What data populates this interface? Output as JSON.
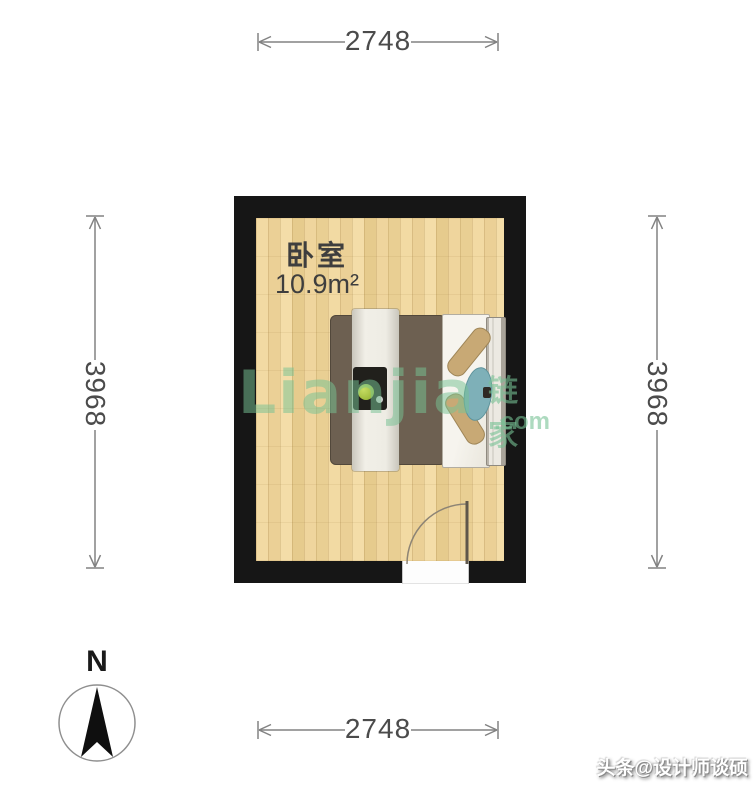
{
  "room": {
    "name": "卧室",
    "area": "10.9m²"
  },
  "dimensions": {
    "top": "2748",
    "bottom": "2748",
    "left": "3968",
    "right": "3968"
  },
  "compass": {
    "label": "N"
  },
  "watermark": {
    "brand": "Lianjia",
    "brand_cn": "链家",
    "suffix": ".com"
  },
  "credit": {
    "text": "头条@设计师谈硕"
  },
  "furniture": {
    "bed": "double-bed-top-view"
  },
  "colors": {
    "wall": "#161616",
    "floor_wood": "#efd59c",
    "bed_blanket": "#6d6051",
    "bed_pillow": "#c8a975",
    "bed_cushion_teal": "#7eb0b8",
    "watermark_green": "#76c194",
    "dimension_line_gray": "#828282",
    "dimension_text_gray": "#4b4b4b"
  }
}
